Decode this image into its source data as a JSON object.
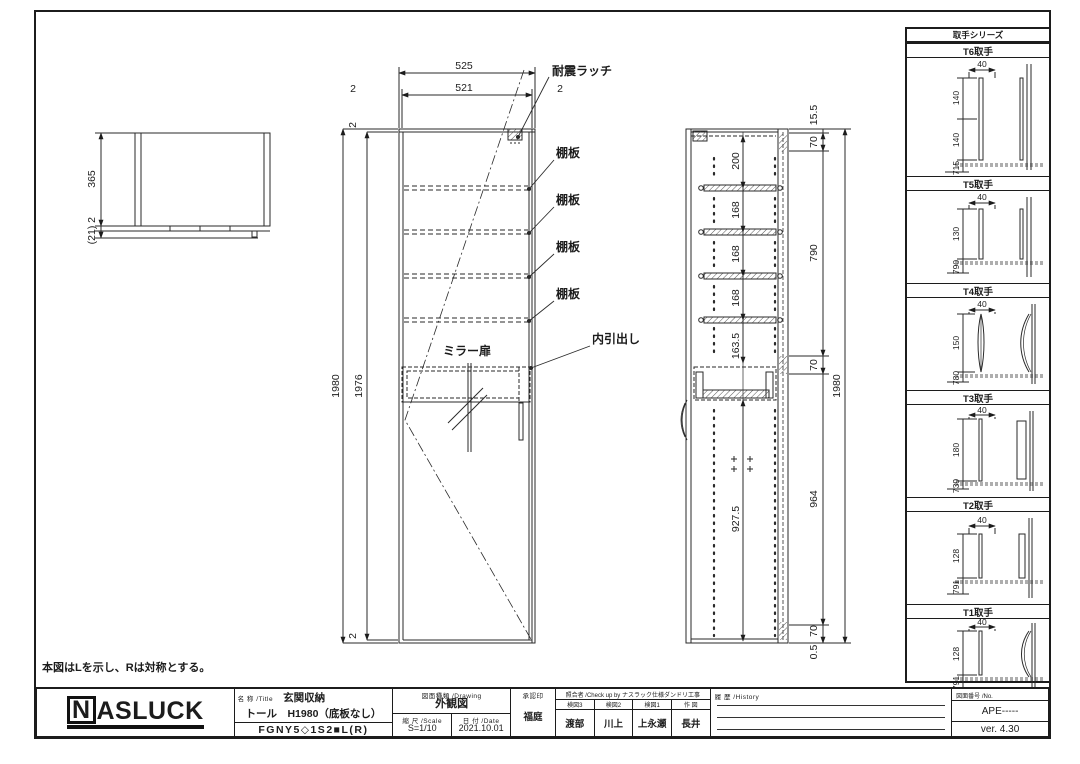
{
  "note": "本図はLを示し、Rは対称とする。",
  "plan": {
    "d365": "365",
    "d2": "2",
    "d21": "(21)"
  },
  "front": {
    "d525": "525",
    "d521": "521",
    "d2l": "2",
    "d2r": "2",
    "d1980": "1980",
    "d1976": "1976",
    "d2t": "2",
    "d2b": "2",
    "label_latch": "耐震ラッチ",
    "shelves": [
      "棚板",
      "棚板",
      "棚板",
      "棚板"
    ],
    "label_mirror": "ミラー扉",
    "label_drawer": "内引出し"
  },
  "section": {
    "inner": [
      "200",
      "168",
      "168",
      "168",
      "163.5",
      "927.5"
    ],
    "right": [
      "15.5",
      "70",
      "790",
      "70",
      "964",
      "70",
      "0.5"
    ],
    "total": "1980"
  },
  "handles": {
    "title": "取手シリーズ",
    "items": [
      {
        "name": "T6取手",
        "w": "40",
        "d1": "140",
        "d2": "140",
        "b": "715"
      },
      {
        "name": "T5取手",
        "w": "40",
        "d1": "130",
        "b": "790"
      },
      {
        "name": "T4取手",
        "w": "40",
        "d1": "150",
        "b": "780"
      },
      {
        "name": "T3取手",
        "w": "40",
        "d1": "180",
        "b": "739"
      },
      {
        "name": "T2取手",
        "w": "40",
        "d1": "128",
        "b": "791"
      },
      {
        "name": "T1取手",
        "w": "40",
        "d1": "128",
        "b": "791"
      }
    ]
  },
  "tb": {
    "logo_n": "N",
    "logo_rest": "ASLUCK",
    "title_header": "名 称 /Title",
    "title_line1": "玄関収納",
    "title_line2": "トール　H1980（底板なし）",
    "title_line3": "FGNY5◇1S2■L(R)",
    "drawing_header": "図面種類 /Drawing",
    "drawing_type": "外観図",
    "scale_header": "縮 尺 /Scale",
    "scale": "S=1/10",
    "date_header": "日 付 /Date",
    "date": "2021.10.01",
    "approval_header": "承認印",
    "approval": "福庭",
    "check_header": "照合者 /Check up by ナスラック仕様ダンドリ工事",
    "check_cols": [
      {
        "role": "検図3",
        "name": "渡部"
      },
      {
        "role": "検図2",
        "name": "川上"
      },
      {
        "role": "検図1",
        "name": "上永瀬"
      },
      {
        "role": "作 図",
        "name": "長井"
      }
    ],
    "history_header": "履 歴 /History",
    "no_header": "図面番号 /No.",
    "drawing_no": "APE-----",
    "version": "ver. 4.30"
  }
}
